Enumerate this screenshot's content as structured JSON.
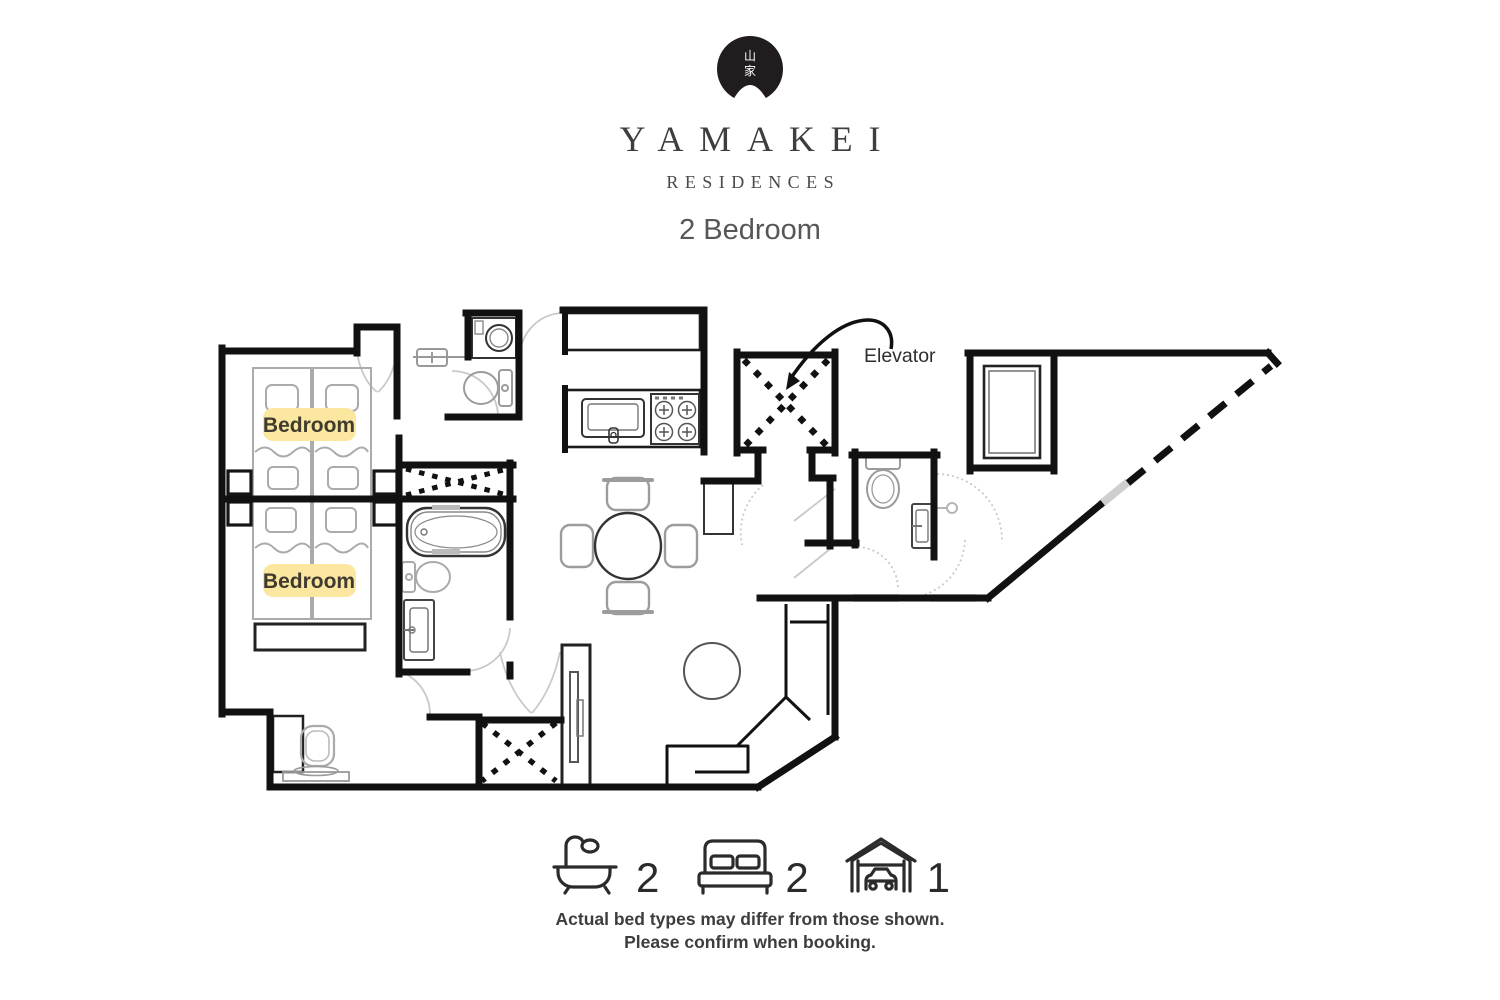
{
  "brand": {
    "logo_glyph_top": "山",
    "logo_glyph_bottom": "家",
    "name": "YAMAKEI",
    "subtitle": "RESIDENCES"
  },
  "unit": {
    "type_label": "2 Bedroom"
  },
  "floor_plan": {
    "room_labels": {
      "bedroom1": "Bedroom",
      "bedroom2": "Bedroom"
    },
    "annotations": {
      "elevator": "Elevator"
    }
  },
  "amenities": {
    "items": [
      {
        "icon": "bathtub-icon",
        "count": "2"
      },
      {
        "icon": "bed-icon",
        "count": "2"
      },
      {
        "icon": "garage-icon",
        "count": "1"
      }
    ]
  },
  "disclaimer": {
    "line1": "Actual bed types may differ from those shown.",
    "line2": "Please confirm when booking."
  },
  "colors": {
    "wall": "#111111",
    "label_highlight": "#fbe7a0",
    "furniture_gray": "#a6a6a6",
    "text_dark": "#3c3c3c",
    "logo_bg": "#211d1e"
  }
}
